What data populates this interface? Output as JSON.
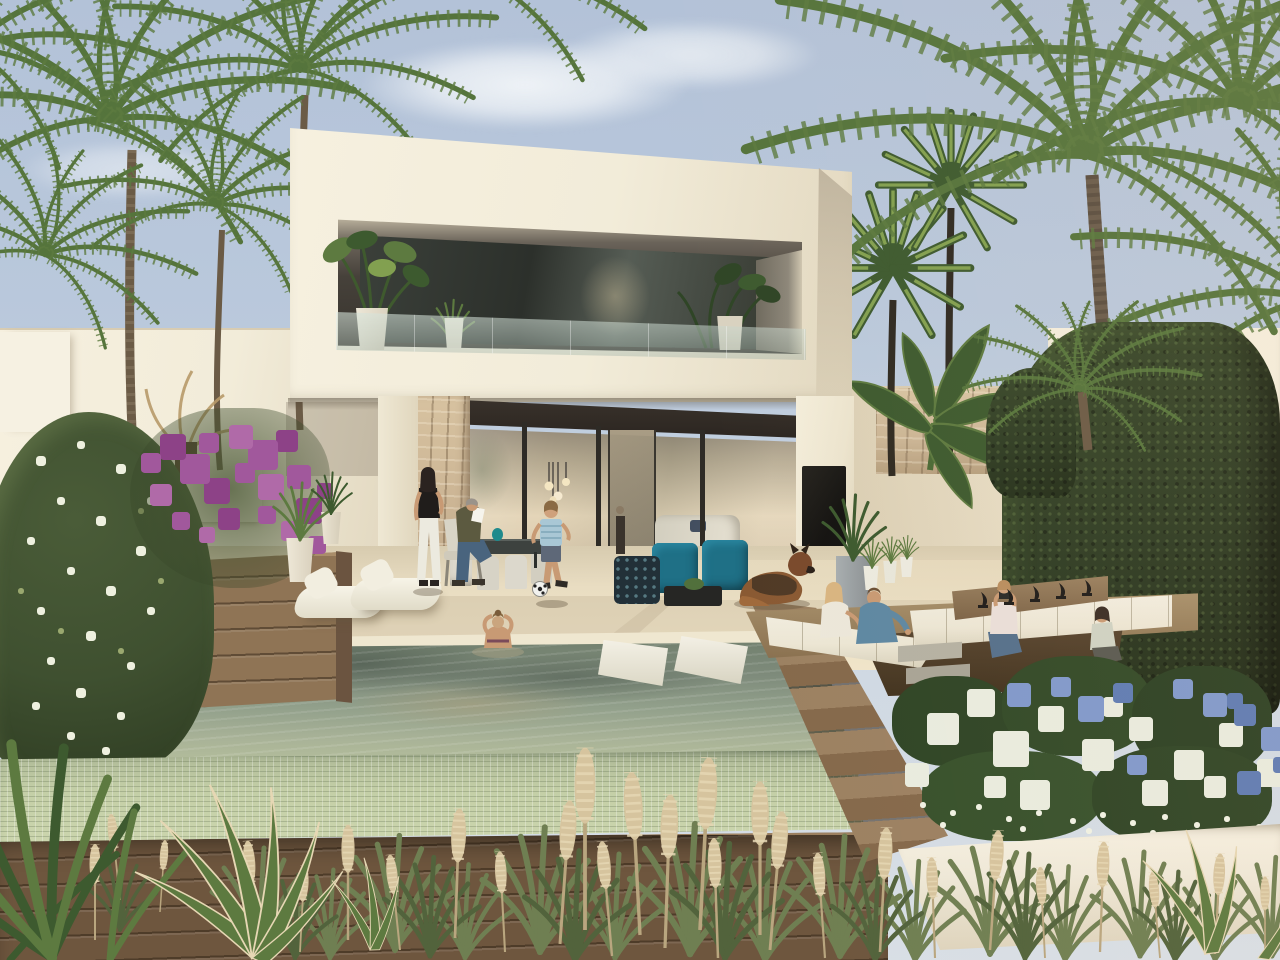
{
  "scene": {
    "setting": "Photorealistic dusk rendering of a modern two-storey white villa with pool garden",
    "sky": "pale blue sky with soft clouds",
    "architecture": [
      "flat-roof white villa with cantilevered upper slab",
      "recessed upper balcony with glass balustrade and potted plants",
      "floor-to-ceiling sliding glass doors to living room",
      "natural stone clad pillar",
      "outdoor media pillar with TV and fireplace",
      "neighbouring white walls left and right"
    ],
    "water_feature": "raised infinity pool with green mosaic overflow edge, submerged white loungers and timber base wall",
    "landscape": [
      "tall tropical palms left and right",
      "two slender fan palms",
      "clipped evergreen hedge wall",
      "purple bougainvillea",
      "white flowering shrub",
      "blue and white hydrangea bed over white planter wall",
      "pampas grass, agave and yucca in the foreground",
      "banana plant and potted palm",
      "row of white plant pots"
    ],
    "people": [
      "woman standing on terrace",
      "man reading at dining table",
      "boy playing with football",
      "woman bathing in the pool",
      "young couple seated in sunken lounge",
      "woman taking a photo in sunken lounge",
      "woman seated at right of sunken lounge"
    ],
    "animals": [
      "german shepherd dog resting on terrace"
    ],
    "furniture": [
      "two white sculptural sun loungers",
      "outdoor dining table with light chairs and pendant lights",
      "teal lounge armchairs with patterned ottoman and coffee table",
      "sunken timber lounge with white cushions and black fire bowls"
    ]
  },
  "colors": {
    "sky-top": "#b3c2d8",
    "sky-low": "#cfd9e4",
    "cloud": "#eef2f6",
    "cream": "#f2ecd9",
    "cream-shade": "#e2d8c0",
    "cream-deep": "#d5c9ae",
    "recess-dark": "#36322c",
    "header-dark": "#2b2520",
    "interior-warm": "#e4d5b8",
    "stone": "#c9b292",
    "terrace": "#e9ddc2",
    "terrace-shade": "#d7cbaf",
    "water-deep": "#73816f",
    "water-mid": "#92a08b",
    "water-shallow": "#b3bd9b",
    "mosaic": "#c4cfa7",
    "wood-dark": "#6e563e",
    "wood-mid": "#85694b",
    "wood-light": "#9c8162",
    "hedge": "#2e3c24",
    "leaf-dark": "#3d5a2f",
    "leaf-mid": "#5d7a40",
    "leaf-lite": "#82a050",
    "palm-line": "#55743c",
    "trunk": "#6b5b46",
    "boug": "#a1589c",
    "boug-deep": "#8d4287",
    "bush-fl": "#eef0df",
    "hyd-white": "#e9ecdf",
    "hyd-blue": "#8099cc",
    "hyd-blue-deep": "#5f7cb4",
    "plume": "#d6c49e",
    "plume-lite": "#e6d7b4",
    "grass": "#6f7f52",
    "grass-dark": "#52633c",
    "cushion": "#ece6d4",
    "teal": "#1f7086",
    "teal-lite": "#2b87a0",
    "dog-brown": "#8a5a33",
    "skin": "#c89a74",
    "denim": "#49647e"
  }
}
